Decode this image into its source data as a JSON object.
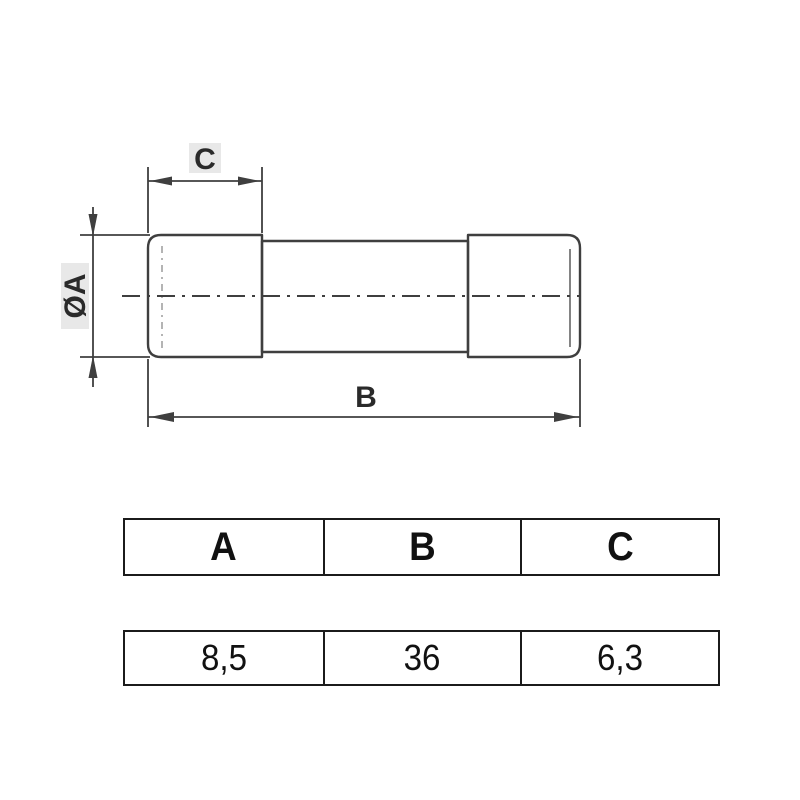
{
  "drawing": {
    "labels": {
      "cap_width": "C",
      "diameter": "ØA",
      "length": "B"
    }
  },
  "table": {
    "headers": [
      "A",
      "B",
      "C"
    ],
    "values": [
      "8,5",
      "36",
      "6,3"
    ]
  },
  "colors": {
    "background": "#ffffff",
    "line": "#3f3f3f",
    "hidden_line": "#8c8c8c",
    "inner_line": "#5a5a5a",
    "label_bg": "#e8e8e8",
    "label_text": "#2a2a2a",
    "table_border": "#1b1b1b",
    "table_text": "#111111"
  }
}
